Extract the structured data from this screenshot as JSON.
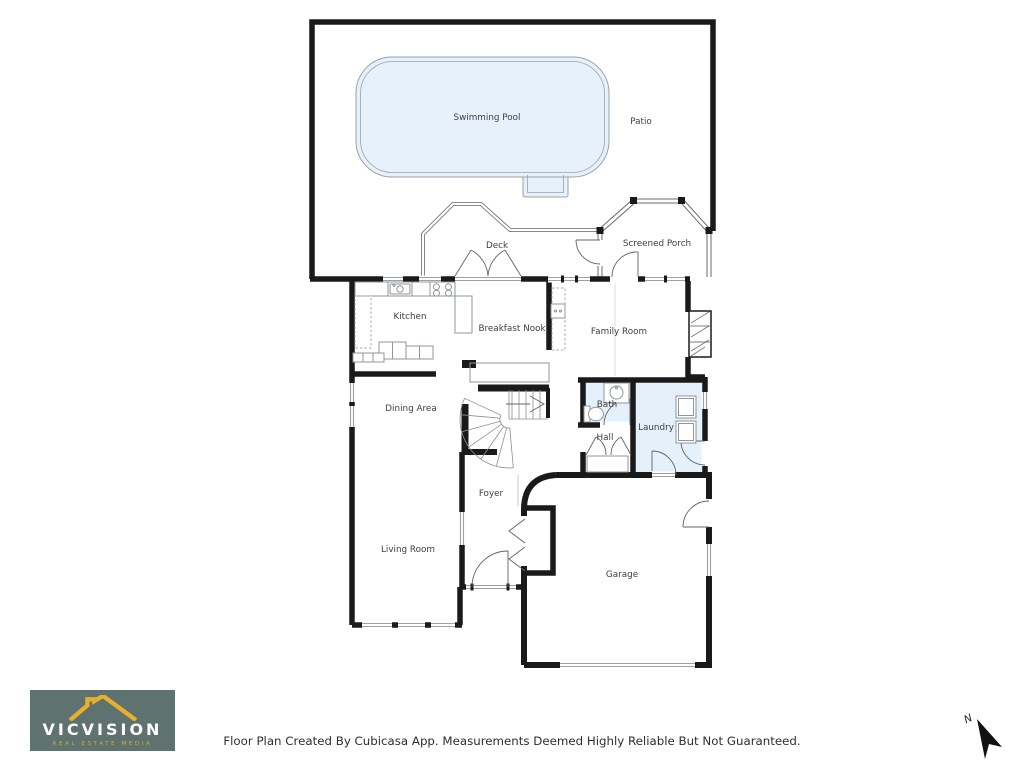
{
  "rooms": [
    {
      "label": "Swimming Pool"
    },
    {
      "label": "Patio"
    },
    {
      "label": "Deck"
    },
    {
      "label": "Screened Porch"
    },
    {
      "label": "Kitchen"
    },
    {
      "label": "Breakfast Nook"
    },
    {
      "label": "Family Room"
    },
    {
      "label": "Dining Area"
    },
    {
      "label": "Bath"
    },
    {
      "label": "Laundry"
    },
    {
      "label": "Hall"
    },
    {
      "label": "Foyer"
    },
    {
      "label": "Living Room"
    },
    {
      "label": "Garage"
    }
  ],
  "footer": {
    "text": "Floor Plan Created By Cubicasa App. Measurements Deemed Highly Reliable But Not Guaranteed."
  },
  "logo": {
    "title": "VICVISION",
    "tagline": "REAL ESTATE MEDIA"
  },
  "compass": {
    "label": "N"
  },
  "colors": {
    "pool_fill": "#e6f1fb",
    "wet_floor": "#e4f0fa",
    "wall": "#1a1a1a",
    "logo_bg": "#5e7370",
    "logo_accent": "#e9af2c",
    "logo_tagline": "#d9a92e"
  }
}
